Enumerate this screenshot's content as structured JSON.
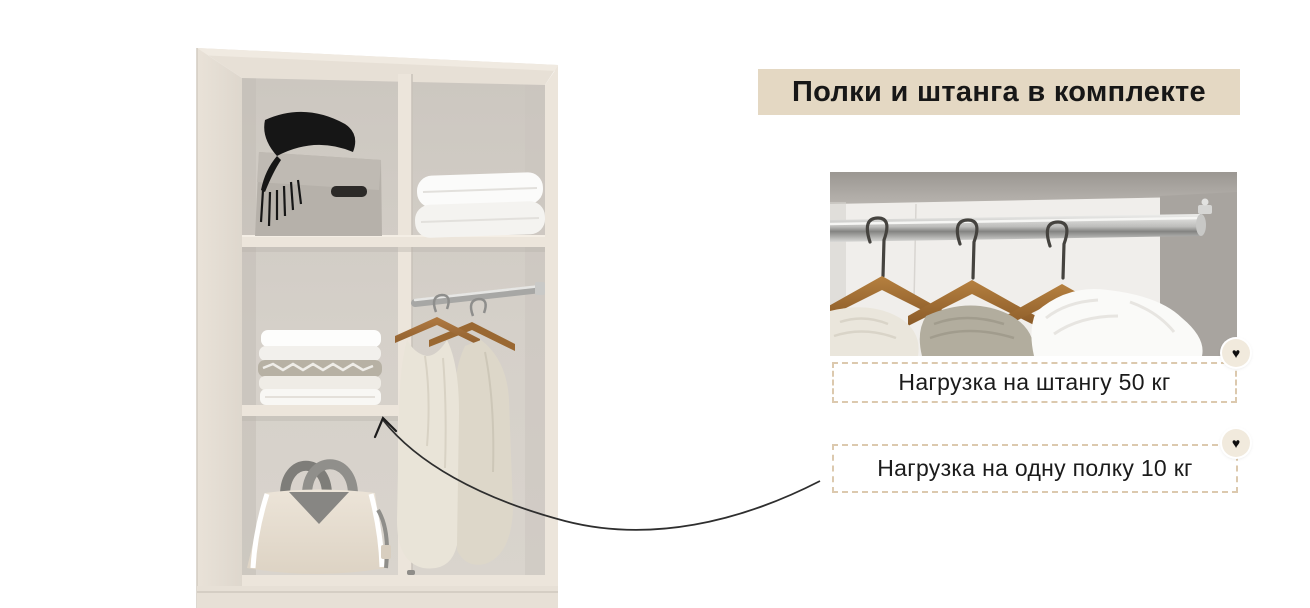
{
  "header": {
    "title": "Полки и штанга в комплекте"
  },
  "callout_cards": [
    {
      "text": "Нагрузка на штангу 50 кг",
      "badge_icon": "heart-icon",
      "badge_glyph": "♥"
    },
    {
      "text": "Нагрузка на одну полку 10 кг",
      "badge_icon": "heart-icon",
      "badge_glyph": "♥"
    }
  ],
  "colors": {
    "page_bg": "#ffffff",
    "header_bg": "#e4d8c3",
    "text": "#1b1b1b",
    "dashed_border": "#dcc9ae",
    "badge_bg": "#f1eadd",
    "wardrobe_cream": "#ebe4da",
    "interior_grey": "#d2cdc6",
    "wood": "#a9743c",
    "chrome": "#b9b9b7",
    "arrow": "#2e2e2e"
  },
  "illustrations": {
    "wardrobe_photo": {
      "name": "wardrobe-open-shelves-photo",
      "depicted_items": [
        "black scarf on grey fabric storage box",
        "two white pillows",
        "stack of folded towels",
        "chrome clothes rail with wooden hangers",
        "two knit tank tops",
        "cream handbag with grey handles",
        "bottom drawer"
      ]
    },
    "inset_photo": {
      "name": "hanging-rod-closeup-photo",
      "depicted_items": [
        "chrome hanging rod with wall bracket",
        "three wooden hangers with metal hooks",
        "cream knitwear",
        "grey knitwear",
        "white towel"
      ]
    }
  }
}
